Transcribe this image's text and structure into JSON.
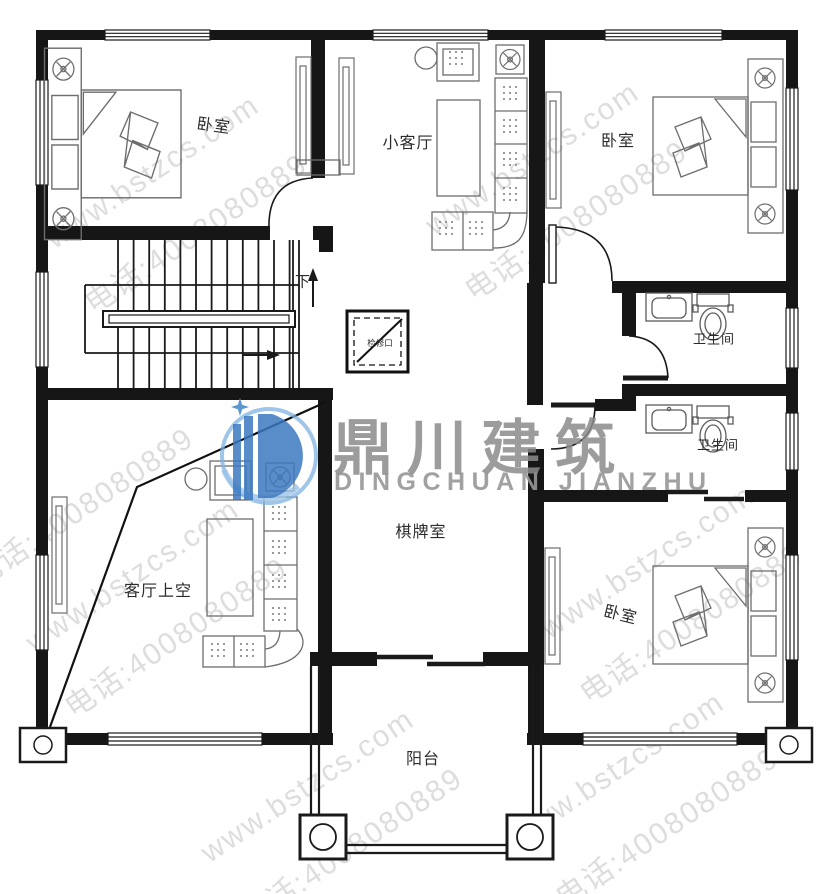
{
  "brand": {
    "logo_cn": "鼎川建筑",
    "logo_en": "DINGCHUAN JIANZHU"
  },
  "watermark": {
    "site": "www.bstzcs.com",
    "phone": "电话:4008080889"
  },
  "rooms": [
    {
      "id": "bedroom-top-left",
      "label": "卧室"
    },
    {
      "id": "small-living-room",
      "label": "小客厅"
    },
    {
      "id": "bedroom-top-right",
      "label": "卧室"
    },
    {
      "id": "bathroom-upper",
      "label": "卫生间"
    },
    {
      "id": "bathroom-lower",
      "label": "卫生间"
    },
    {
      "id": "game-room",
      "label": "棋牌室"
    },
    {
      "id": "living-room-void",
      "label": "客厅上空"
    },
    {
      "id": "bedroom-bottom-right",
      "label": "卧室"
    },
    {
      "id": "balcony",
      "label": "阳台"
    },
    {
      "id": "stairs-down",
      "label": "下"
    },
    {
      "id": "access-hatch",
      "label": "检修口"
    }
  ]
}
